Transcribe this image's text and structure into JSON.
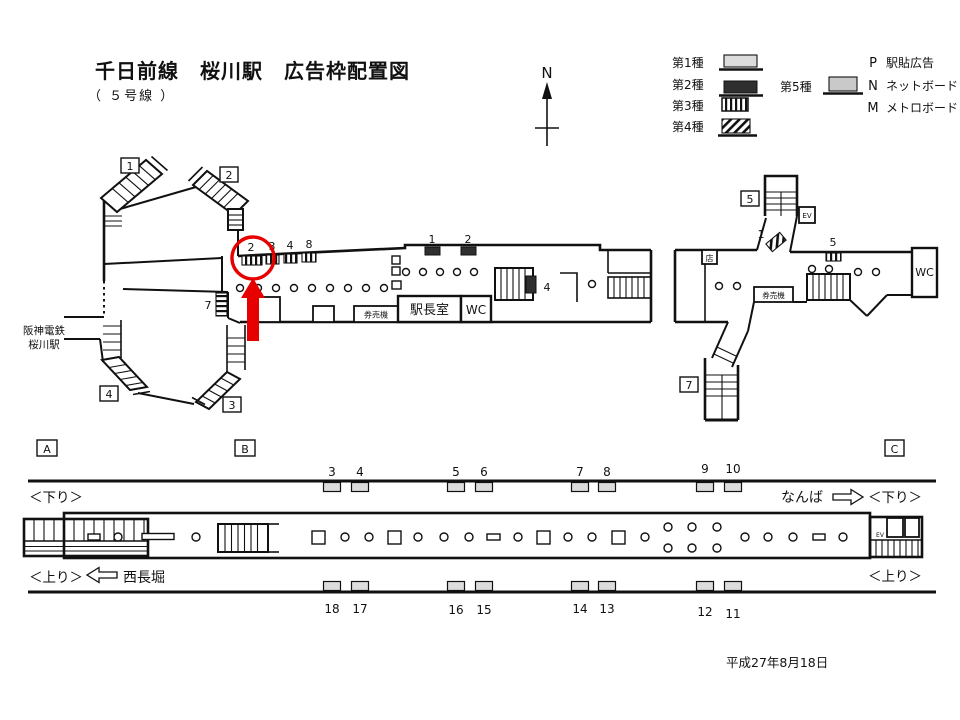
{
  "header": {
    "title": "千日前線　桜川駅　広告枠配置図",
    "subtitle": "（ ５号線 ）"
  },
  "compass": {
    "north": "N"
  },
  "legend": {
    "type1": "第1種",
    "type2": "第2種",
    "type3": "第3種",
    "type4": "第4種",
    "type5": "第5種",
    "p_key": "P",
    "p_label": "駅貼広告",
    "n_key": "N",
    "n_label": "ネットボード",
    "m_key": "M",
    "m_label": "メトロボード"
  },
  "concourse": {
    "hanshin_line1": "阪神電鉄",
    "hanshin_line2": "桜川駅",
    "exits": {
      "e1": "1",
      "e2": "2",
      "e3": "3",
      "e4": "4",
      "e5": "5",
      "e7": "7"
    },
    "left_ads": {
      "pos2": "2",
      "pos3": "3",
      "pos4": "4",
      "pos8": "8",
      "pos7": "7",
      "board1": "1",
      "board2": "2",
      "board4": "4"
    },
    "right_ads": {
      "pos1": "1",
      "pos5": "5"
    },
    "rooms": {
      "master": "駅長室",
      "wc": "WC",
      "ticket": "券売機",
      "shop": "店",
      "ticket_right": "券売機",
      "wc_right": "WC",
      "elevator": "EV"
    }
  },
  "platform": {
    "sections": {
      "a": "A",
      "b": "B",
      "c": "C"
    },
    "top_positions": [
      "3",
      "4",
      "5",
      "6",
      "7",
      "8",
      "9",
      "10"
    ],
    "bottom_positions": [
      "18",
      "17",
      "16",
      "15",
      "14",
      "13",
      "12",
      "11"
    ],
    "left_down": "＜下り＞",
    "left_up": "＜上り＞",
    "right_down": "＜下り＞",
    "right_up": "＜上り＞",
    "west_dest": "西長堀",
    "east_dest": "なんば",
    "elevator": "EV"
  },
  "footer": {
    "date": "平成27年8月18日"
  },
  "colors": {
    "annotation": "#e60000",
    "type1_fill": "#dcdcdc",
    "type2_fill": "#2f2f2f",
    "type5_fill": "#c9c9c9"
  }
}
